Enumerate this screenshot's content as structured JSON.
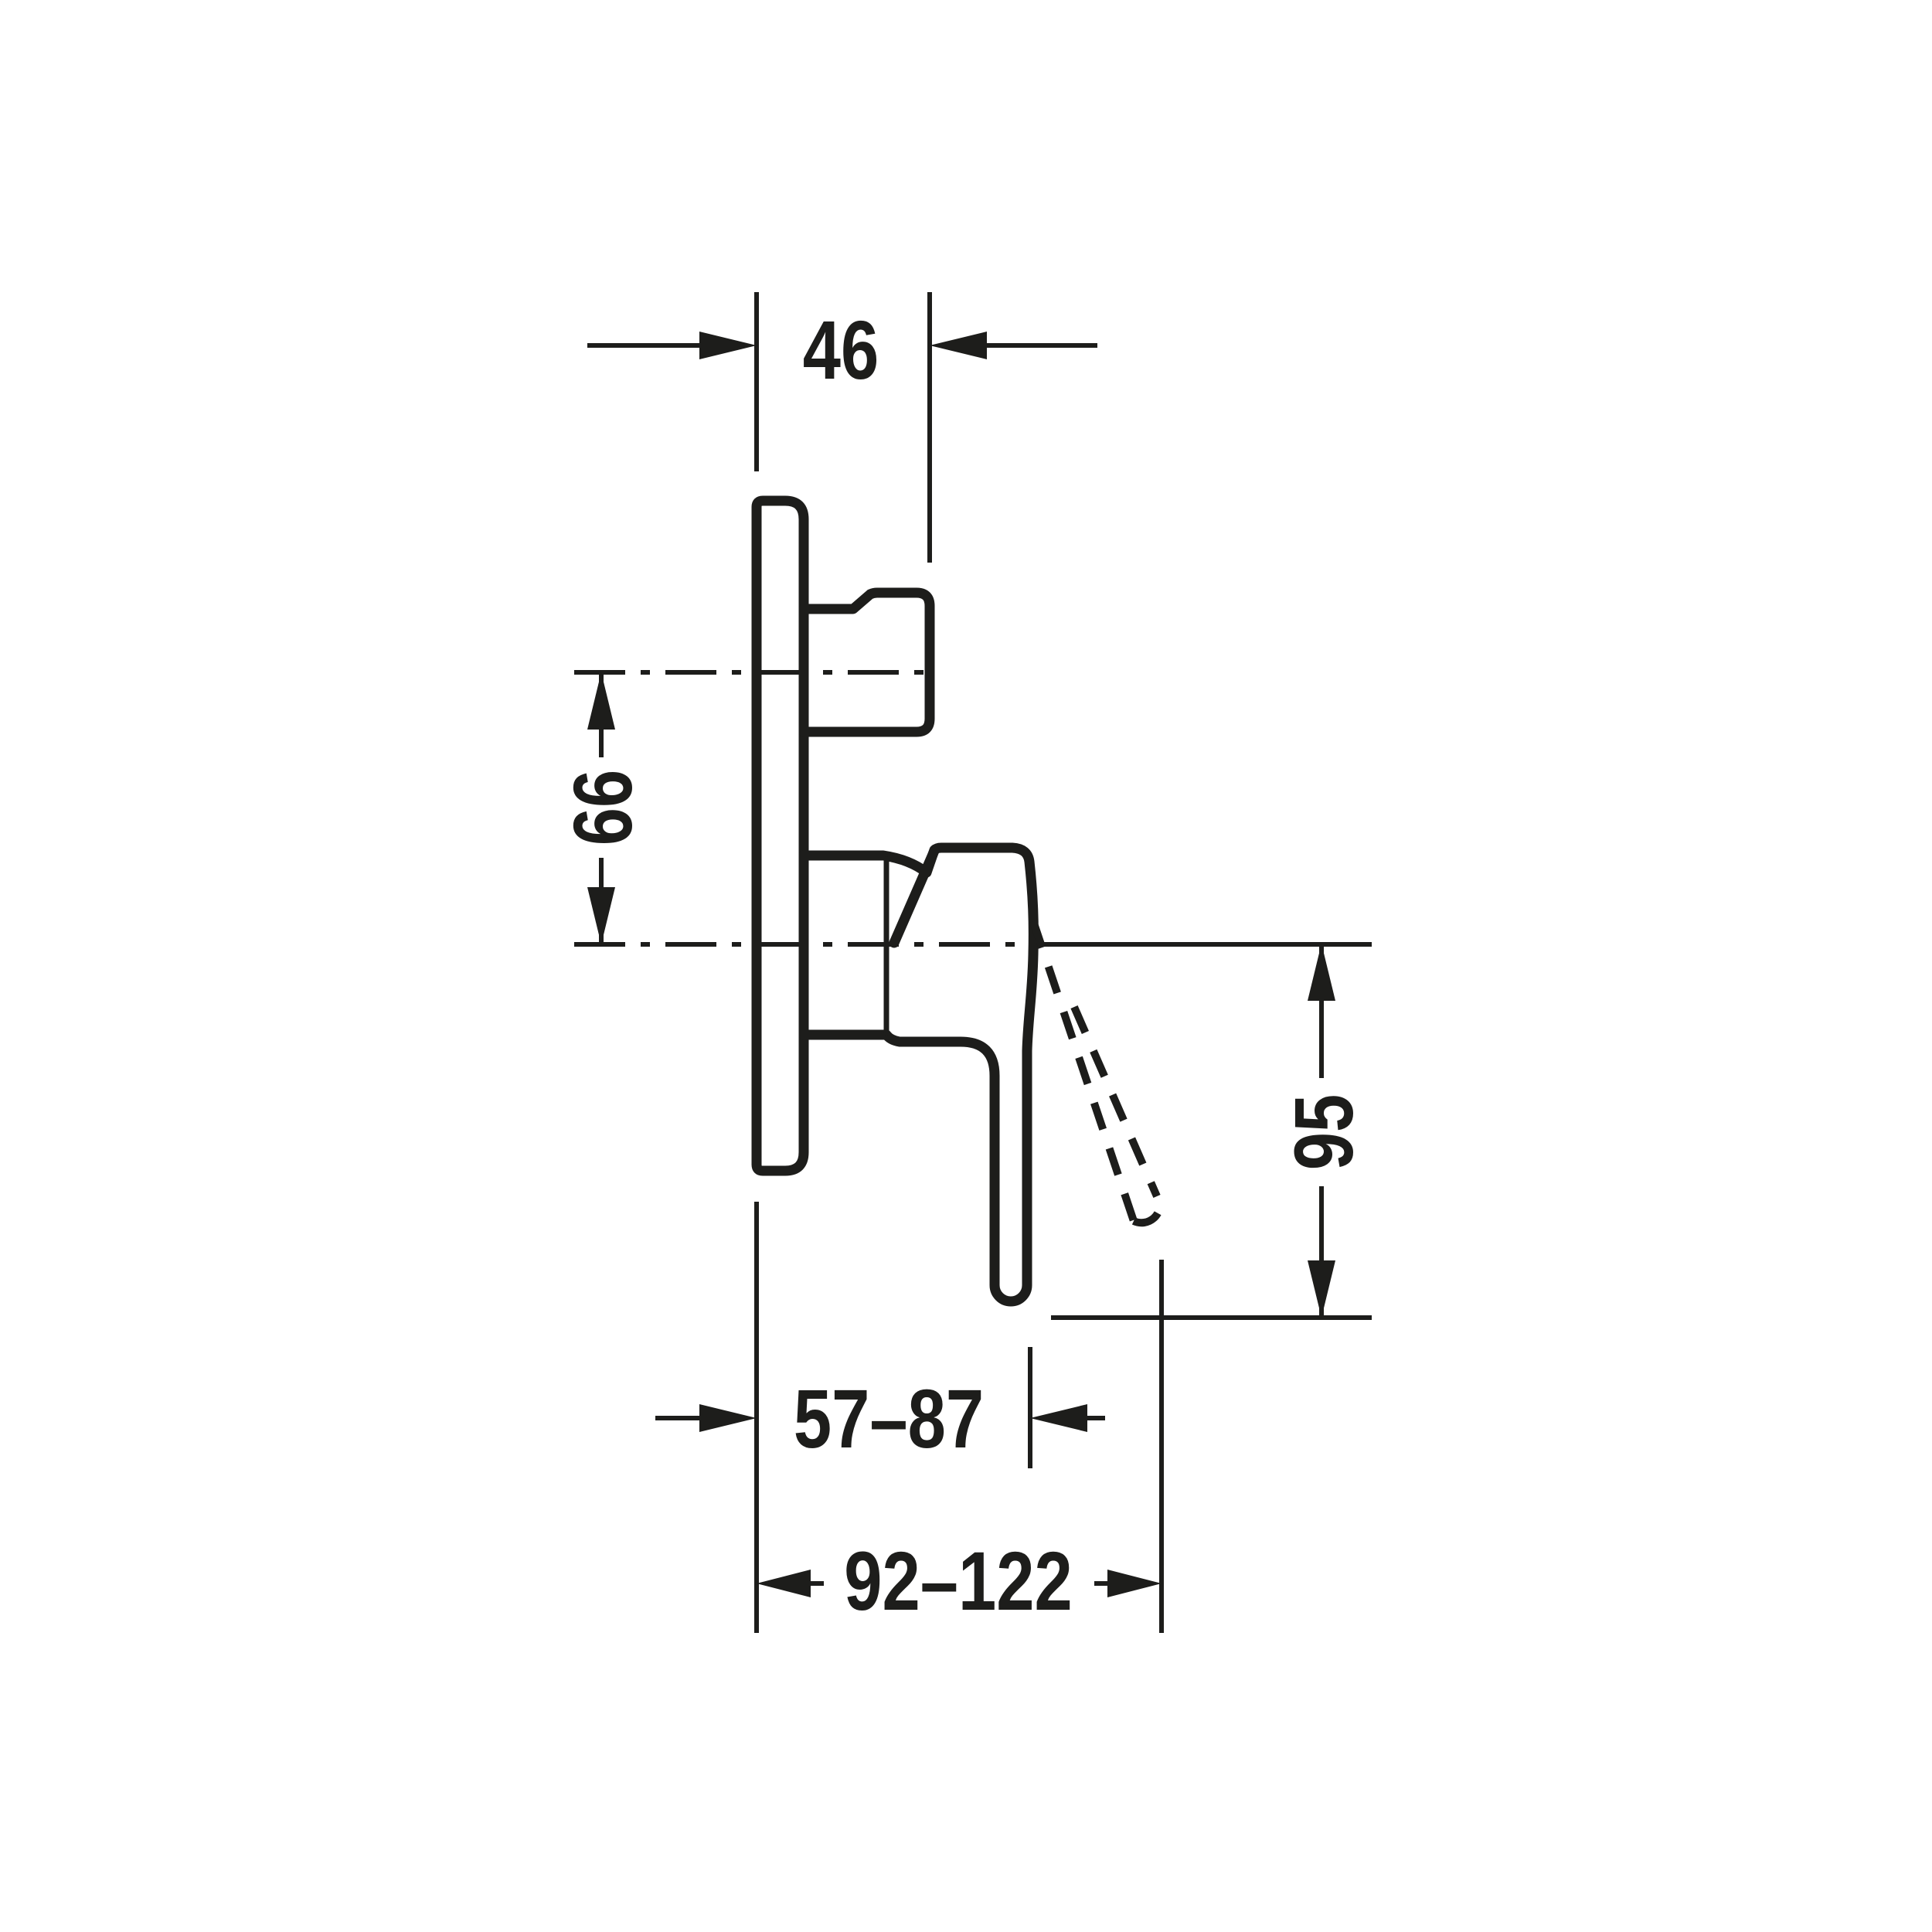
{
  "drawing": {
    "background": "#ffffff",
    "line_color": "#1d1d1b",
    "dimensions": {
      "knob_depth": "46",
      "axis_spacing": "66",
      "lever_drop": "95",
      "wall_to_lever": "57–87",
      "wall_to_open_lever": "92–122"
    }
  }
}
